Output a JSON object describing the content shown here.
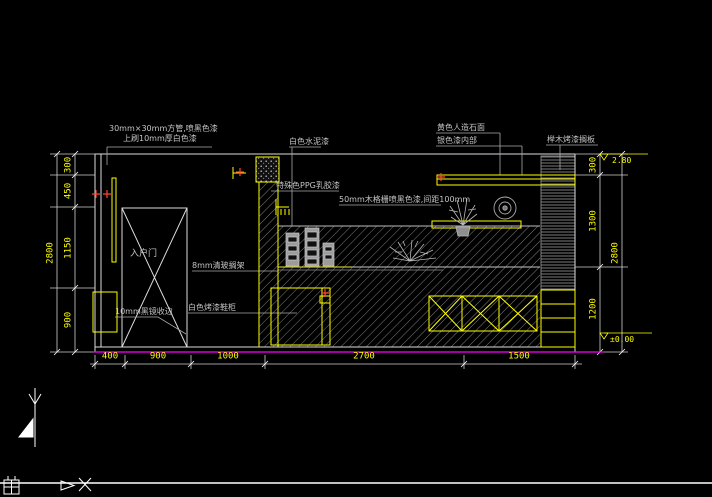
{
  "drawing": {
    "title_context": "interior-elevation-cad-view",
    "annotations": {
      "tube_note_1": "30mm×30mm方管,喷黑色漆",
      "tube_note_2": "上刷10mm厚白色漆",
      "ceiling_paint": "白色水泥漆",
      "ppg_paint": "特殊色PPG乳胶漆",
      "slat_note": "50mm木格栅喷黑色漆,间距100mm",
      "glass_shelf_note": "8mm清玻搁架",
      "cabinet_note": "白色烤漆鞋柜",
      "mirror_trim_note": "10mm黑镜收边",
      "stone_note": "黄色人造石面",
      "inner_note": "银色漆内部",
      "shelf_note": "榉木烤漆搁板",
      "door_label": "入户门"
    },
    "dimensions": {
      "bottom": [
        "400",
        "900",
        "1000",
        "2700",
        "1500"
      ],
      "left": [
        "300",
        "450",
        "1150",
        "900"
      ],
      "left_total": "2800",
      "right": [
        "300",
        "1300",
        "1200"
      ],
      "right_total": "2800"
    },
    "levels": {
      "top": "2.80",
      "bottom": "±0.00"
    },
    "colors": {
      "background": "#000000",
      "line_white": "#dcdcdc",
      "hatch_gray": "#8a8a8a",
      "annotation_text": "#c4c4c4",
      "dimension_text": "#ffff00",
      "accent_yellow": "#ffff00",
      "floor_line_magenta": "#ff00ff",
      "marker_red": "#ff4632"
    },
    "icons": {
      "ucs_grid": "grid-icon",
      "ucs_arrow": "triangle-arrow-icon",
      "ucs_x": "x-axis-icon",
      "section_marker": "section-arrow-icon"
    }
  }
}
